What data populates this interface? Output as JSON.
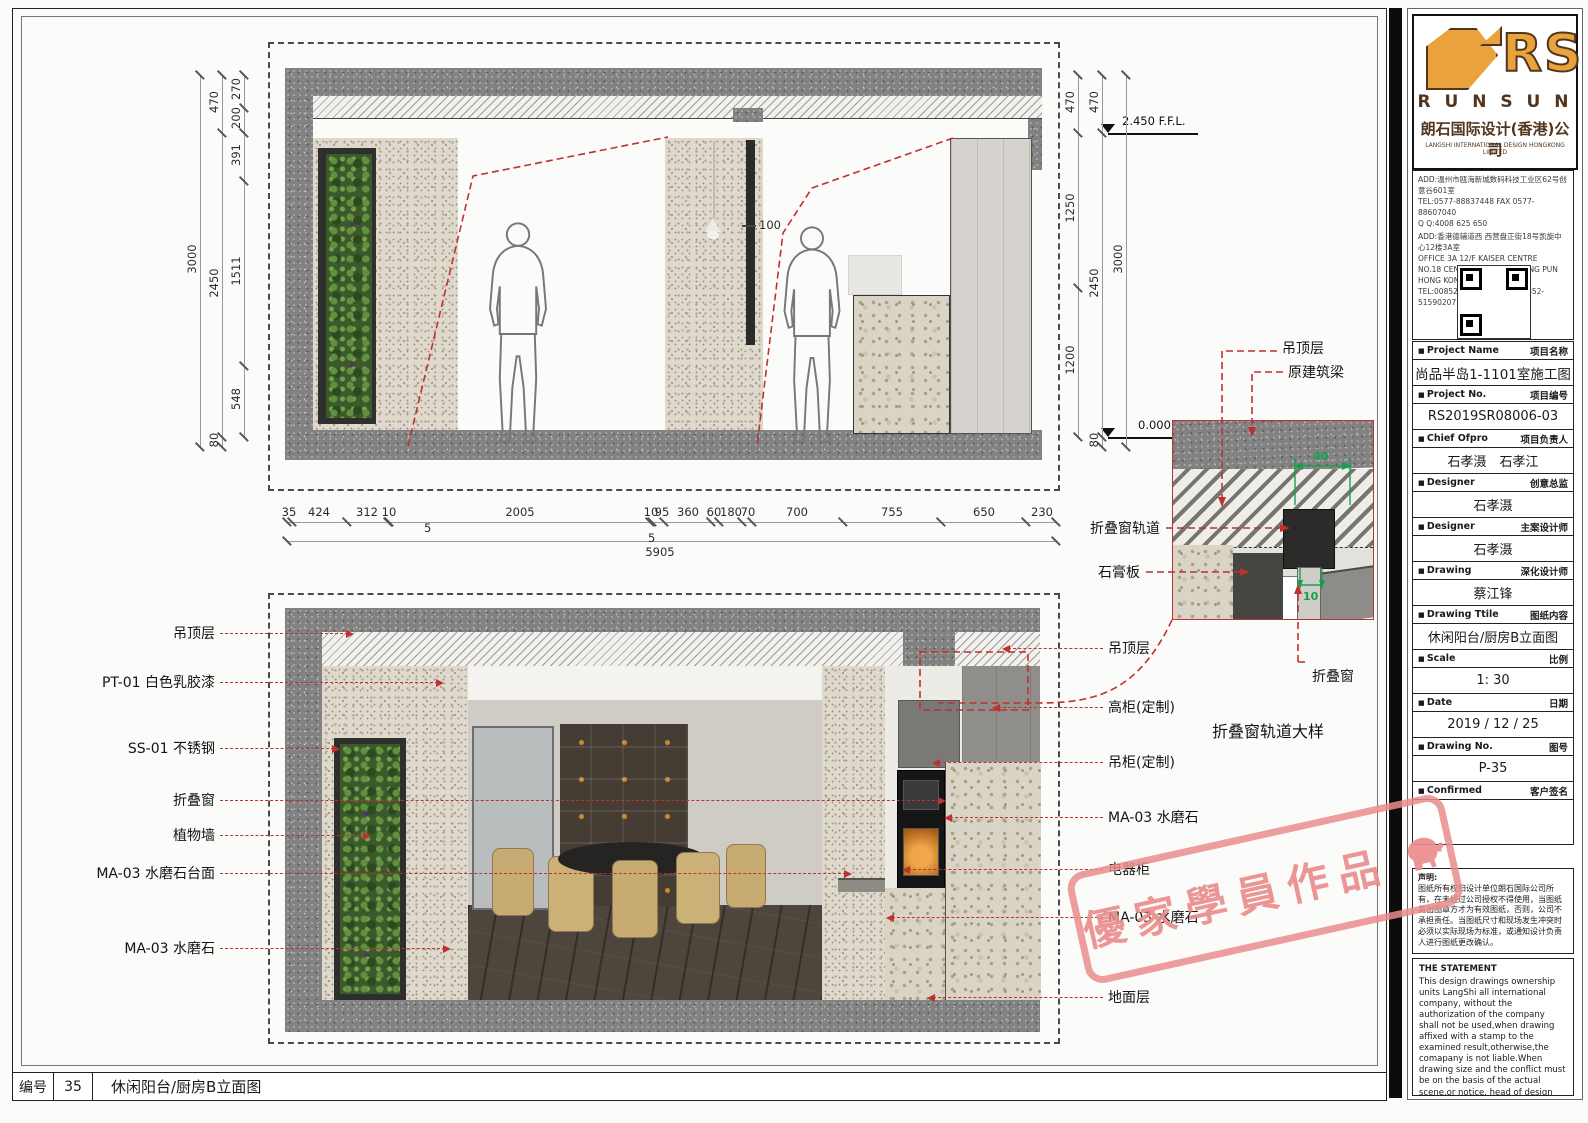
{
  "sheet": {
    "number_label": "编号",
    "number": "35",
    "title": "休闲阳台/厨房B立面图"
  },
  "elevation": {
    "level_top": "2.450 F.F.L.",
    "level_bottom": "0.000 F.F.L.",
    "track_offset": "100",
    "dims_left_outer": [
      "3000"
    ],
    "dims_left_mid": [
      "470",
      "2450",
      "80"
    ],
    "dims_left_inner": [
      "270",
      "200",
      "391",
      "1511",
      "548"
    ],
    "dims_right_inner": [
      "470",
      "1250",
      "1200"
    ],
    "dims_right_mid": [
      "470",
      "2450",
      "80"
    ],
    "dims_right_outer": [
      "3000"
    ],
    "dims_bottom": [
      "35",
      "424",
      "312",
      "10",
      "2005",
      "10",
      "95",
      "360",
      "60",
      "180",
      "70",
      "700",
      "755",
      "650",
      "230"
    ],
    "dims_bottom_fives": [
      "5",
      "5"
    ],
    "dims_bottom_total": "5905"
  },
  "callouts": {
    "left": [
      "吊顶层",
      "PT-01 白色乳胶漆",
      "SS-01 不锈钢",
      "折叠窗",
      "植物墙",
      "MA-03 水磨石台面",
      "MA-03 水磨石"
    ],
    "right": [
      "吊顶层",
      "高柜(定制)",
      "吊柜(定制)",
      "MA-03 水磨石",
      "电器柜",
      "MA-03 水磨石",
      "地面层"
    ]
  },
  "detail": {
    "label_ceiling": "吊顶层",
    "label_beam": "原建筑梁",
    "label_track": "折叠窗轨道",
    "label_gypsum": "石膏板",
    "label_window": "折叠窗",
    "dim_top": "40",
    "dim_bottom": "10",
    "caption": "折叠窗轨道大样"
  },
  "titleblock": {
    "logo": {
      "rs": "RS",
      "name_spaced": "R U N S U N",
      "company_cn": "朗石国际设计(香港)公司",
      "company_en": "LANGSHI INTERNATIONAL DESIGN HONGKONG LIMITED"
    },
    "contact": {
      "add1": "ADD:温州市瓯海新城数码科技工业区62号创意谷601室",
      "tel1": "TEL:0577-88837448 FAX 0577-88607040",
      "qq": "Q Q:4008 625 650",
      "add2_cn": "ADD:香港德辅道西 西营盘正街18号凯旋中心12楼3A室",
      "add2_en1": "OFFICE 3A 12/F KAISER CENTRE",
      "add2_en2": "NO.18 CENTRE STREET SAI YING PUN",
      "add2_en3": "HONG KONG",
      "tel2": "TEL:00852-81824111 FAX:00852-51590207"
    },
    "rows": [
      {
        "en": "Project Name",
        "cn": "项目名称",
        "value": "尚品半岛1-1101室施工图"
      },
      {
        "en": "Project No.",
        "cn": "项目编号",
        "value": "RS2019SR08006-03"
      },
      {
        "en": "Chief Ofpro",
        "cn": "项目负责人",
        "value": "石孝滠　石孝江"
      },
      {
        "en": "Designer",
        "cn": "创意总监",
        "value": "石孝滠"
      },
      {
        "en": "Designer",
        "cn": "主案设计师",
        "value": "石孝滠"
      },
      {
        "en": "Drawing",
        "cn": "深化设计师",
        "value": "蔡江锋"
      },
      {
        "en": "Drawing Ttile",
        "cn": "图纸内容",
        "value": "休闲阳台/厨房B立面图"
      },
      {
        "en": "Scale",
        "cn": "比例",
        "value": "1: 30"
      },
      {
        "en": "Date",
        "cn": "日期",
        "value": "2019 / 12 / 25"
      },
      {
        "en": "Drawing No.",
        "cn": "图号",
        "value": "P-35"
      },
      {
        "en": "Confirmed",
        "cn": "客户签名",
        "value": ""
      }
    ],
    "statement_cn_title": "声明:",
    "statement_cn": "图纸所有权归设计单位朗石国际公司所有，在未经过公司授权不得使用，当图纸盖出图章方才为有效图纸，否则，公司不承担责任。当图纸尺寸和现场发生冲突时必须以实际现场为标准，或通知设计负责人进行图纸更改确认。",
    "statement_en_title": "THE STATEMENT",
    "statement_en": "This design drawings ownership units LangShi all international company, without the authorization of the company shall not be used,when drawing affixed with a stamp to the examined result,otherwise,the comapany is not liable.When drawing size and the conflict must be on the basis of the actual scene,or notice, head of design for drawing change confirmation."
  },
  "stamp": {
    "text": "優家學員作品"
  },
  "colors": {
    "leader_red": "#c03030",
    "dim_green": "#17a04b",
    "logo_orange": "#e9a23c",
    "logo_brown": "#52351c",
    "stamp_pink": "#e98c8c"
  }
}
